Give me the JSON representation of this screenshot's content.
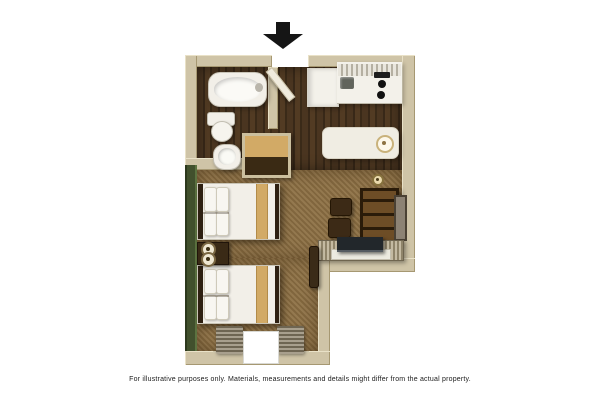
{
  "figure": {
    "type": "studio-suite-floor-plan",
    "disclaimer": "For illustrative purposes only.  Materials, measurements and details might differ from the actual property.",
    "entrance_marker": "down-arrow-icon",
    "rooms": [
      "bathroom",
      "entry-hall",
      "kitchen",
      "bedroom-living-area"
    ],
    "furniture_and_fixtures": [
      "bathtub",
      "toilet",
      "pedestal-sink",
      "vanity-cabinet",
      "entry-door",
      "refrigerator",
      "kitchen-counter",
      "kitchen-sink",
      "cooktop-burners",
      "kitchen-island",
      "island-stool",
      "double-bed-1",
      "double-bed-2",
      "nightstand-with-lamp",
      "dining-chair-1",
      "dining-chair-2",
      "shelving-cabinet",
      "wall-mirror",
      "media-desk",
      "tv",
      "luggage-rack",
      "window-with-curtains",
      "ceiling-fixture"
    ]
  },
  "colors": {
    "background": "#ffffff",
    "wall": "#cfc4a7",
    "wall_edge": "#a69872",
    "wood": "#42301d",
    "carpet": "#8c7046",
    "green_wall": "#41502d",
    "fixture_white": "#f2efe8",
    "counter_white": "#f3f1ea",
    "accent_tan": "#d2aa66",
    "furniture_dark": "#3a2a16",
    "curtain": "#6e6552",
    "arrow_black": "#151515",
    "text_color": "#1b1b1b"
  }
}
